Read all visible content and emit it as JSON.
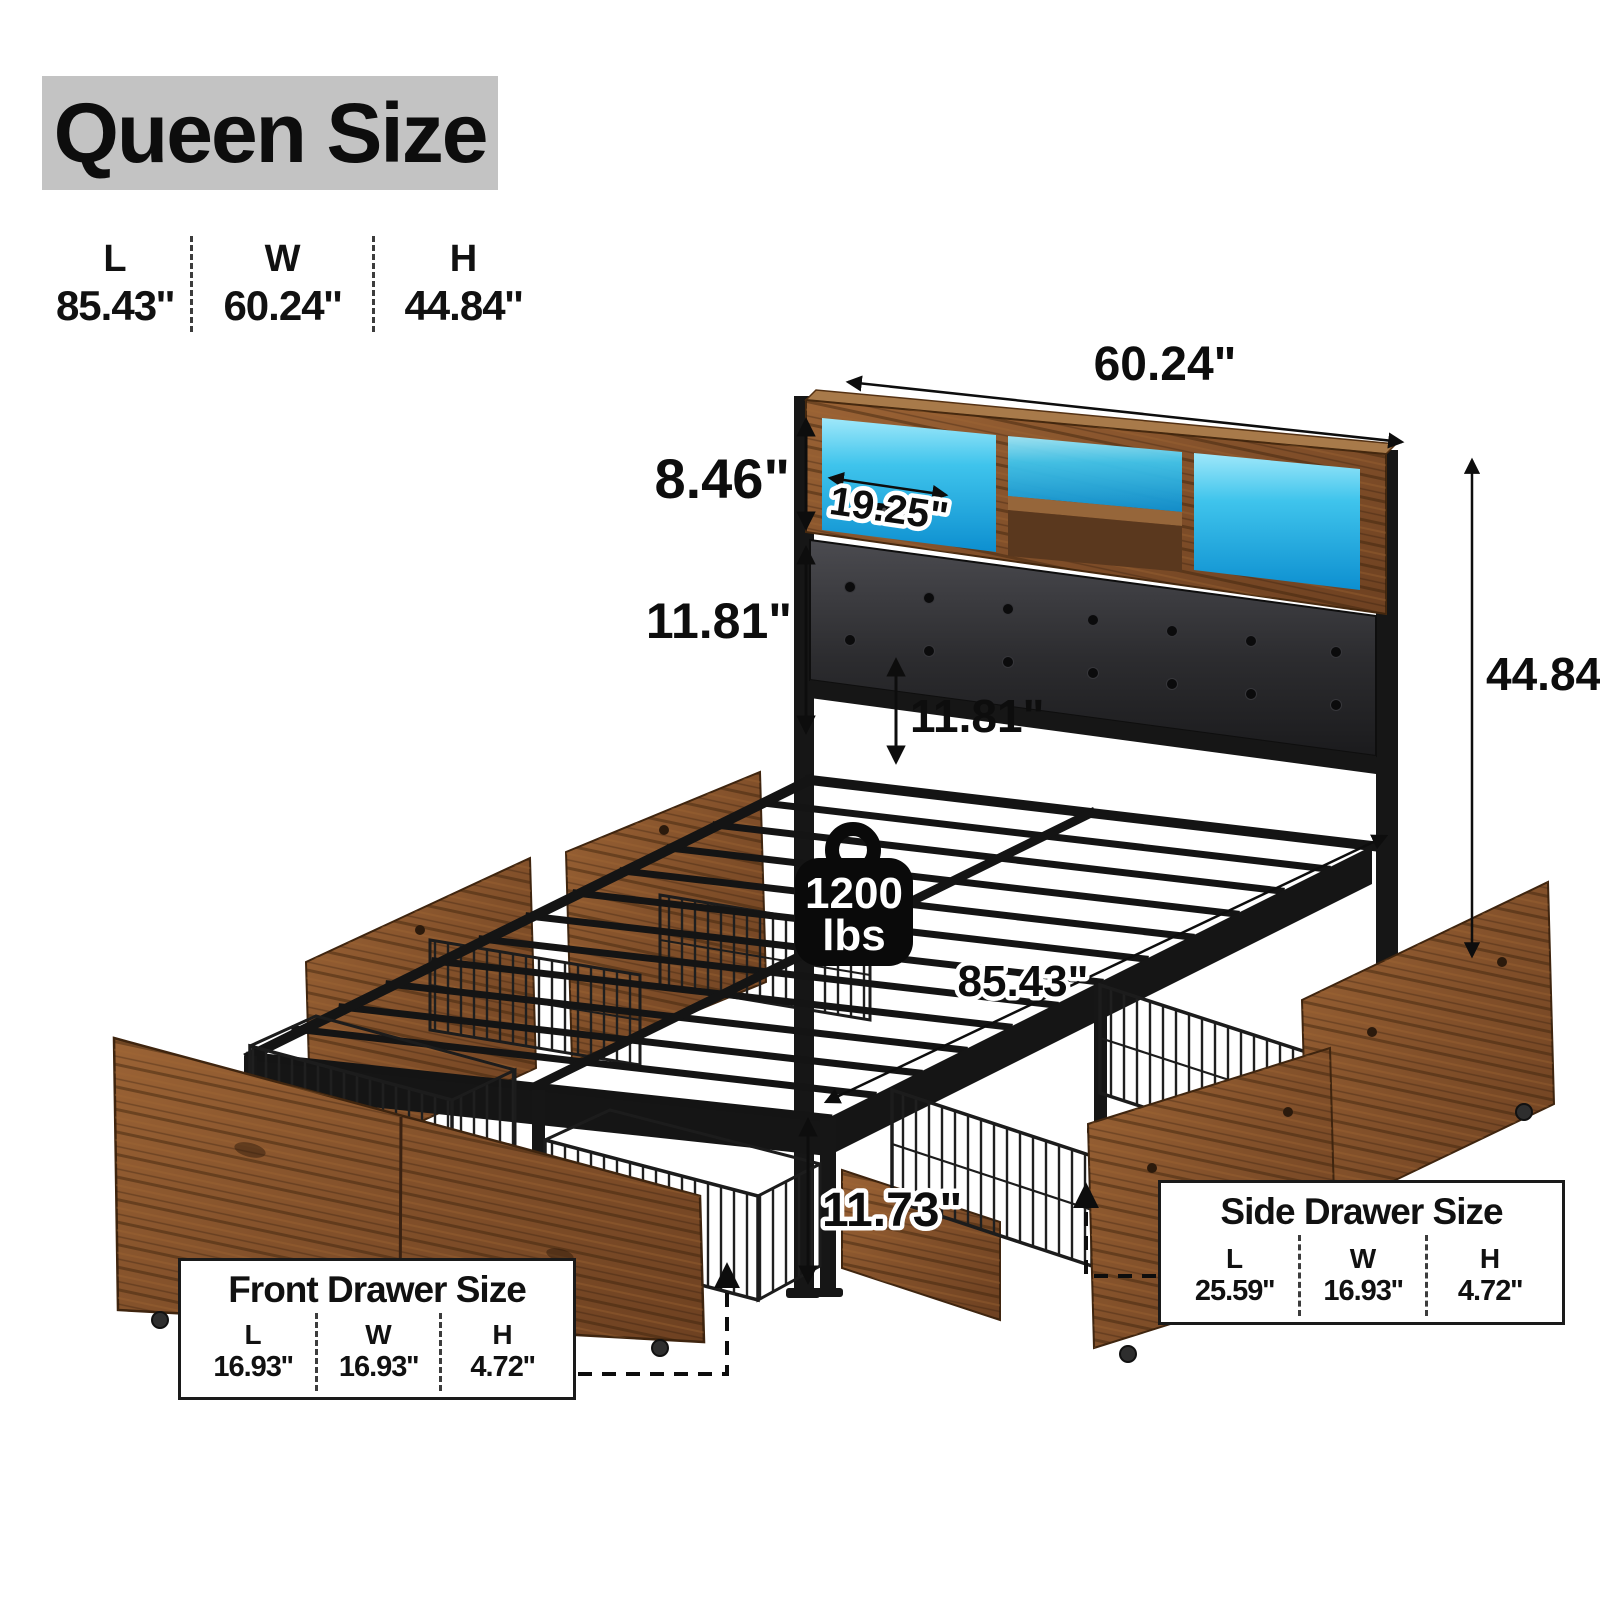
{
  "header": {
    "title": "Queen Size"
  },
  "overall_dims": [
    {
      "label": "L",
      "value": "85.43''"
    },
    {
      "label": "W",
      "value": "60.24''"
    },
    {
      "label": "H",
      "value": "44.84''"
    }
  ],
  "annotations": {
    "headboard_width": "60.24\"",
    "shelf_height": "8.46\"",
    "shelf_depth": "19.25\"",
    "headboard_panel_height": "11.81\"",
    "headboard_to_frame": "11.81\"",
    "total_height": "44.84\"",
    "bed_length": "85.43\"",
    "leg_height": "11.73\"",
    "weight_capacity": {
      "value": "1200",
      "unit": "lbs"
    }
  },
  "front_drawer": {
    "title": "Front Drawer Size",
    "dims": [
      {
        "label": "L",
        "value": "16.93''"
      },
      {
        "label": "W",
        "value": "16.93''"
      },
      {
        "label": "H",
        "value": "4.72''"
      }
    ]
  },
  "side_drawer": {
    "title": "Side Drawer Size",
    "dims": [
      {
        "label": "L",
        "value": "25.59''"
      },
      {
        "label": "W",
        "value": "16.93''"
      },
      {
        "label": "H",
        "value": "4.72''"
      }
    ]
  },
  "colors": {
    "led_glow": "#3fc4ec",
    "rustic_wood": "#8a5a33",
    "metal_black": "#161616",
    "title_background": "#c3c3c3"
  }
}
